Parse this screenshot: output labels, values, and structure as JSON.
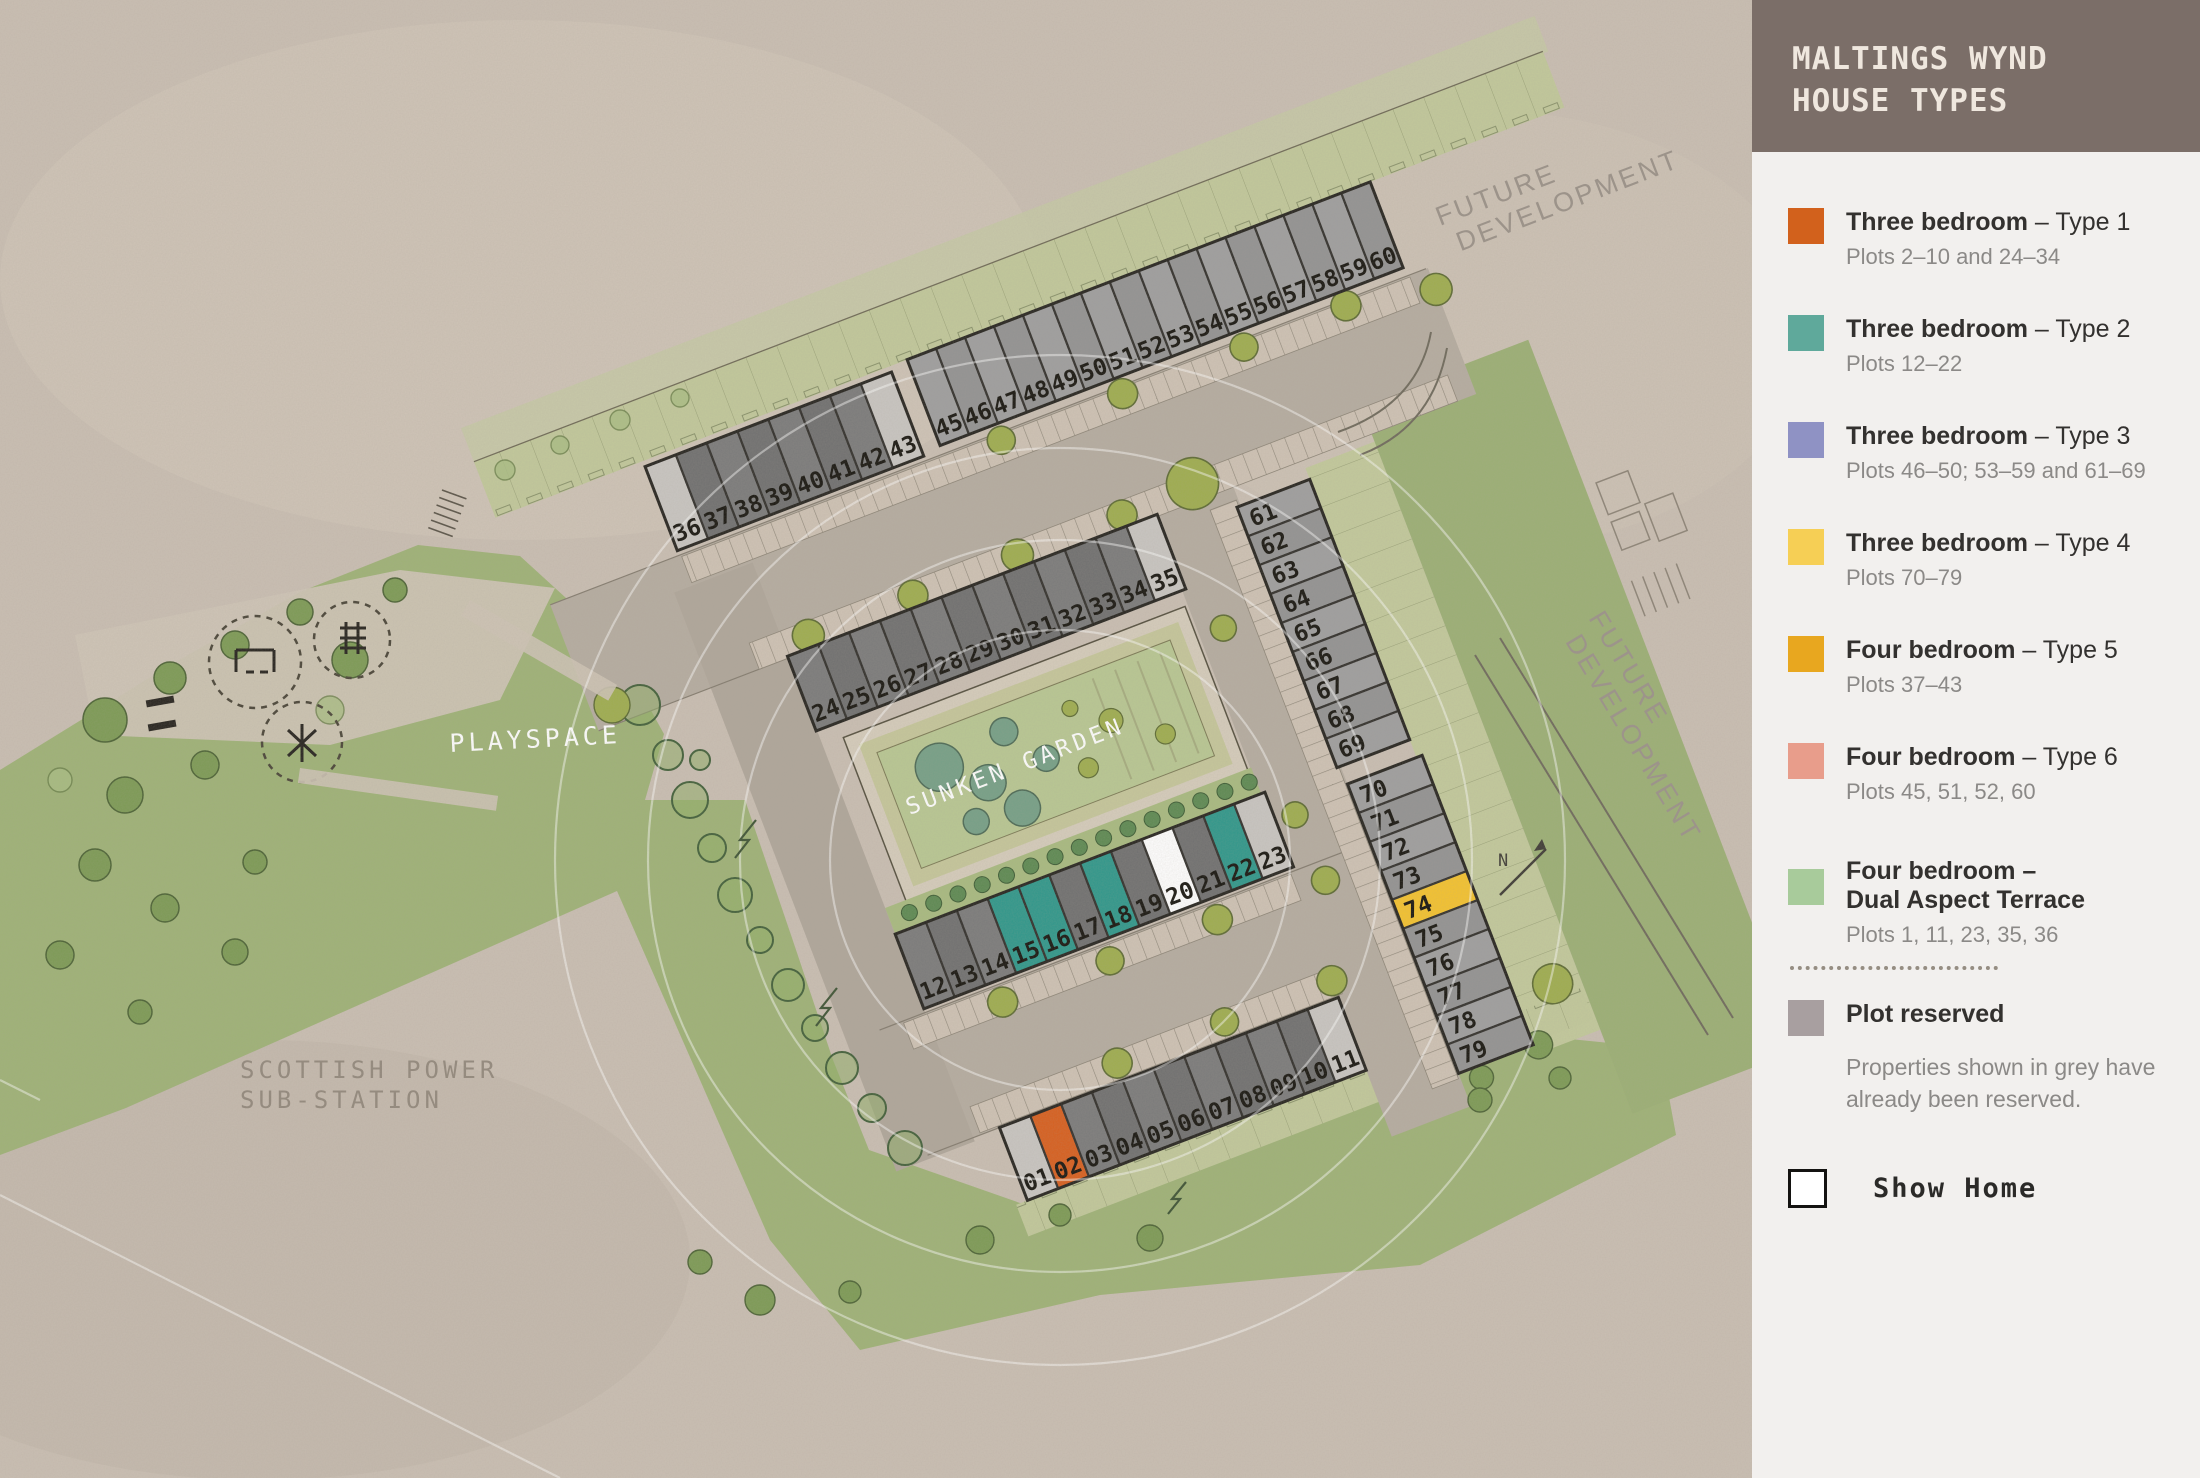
{
  "legend": {
    "title_line1": "MALTINGS WYND",
    "title_line2": "HOUSE TYPES",
    "items": [
      {
        "bold": "Three bedroom",
        "rest": " – Type 1",
        "sub": "Plots 2–10 and 24–34",
        "color": "#d2611c"
      },
      {
        "bold": "Three bedroom",
        "rest": " – Type 2",
        "sub": "Plots 12–22",
        "color": "#5fa99b"
      },
      {
        "bold": "Three bedroom",
        "rest": " – Type 3",
        "sub": "Plots 46–50; 53–59 and 61–69",
        "color": "#8f92c4"
      },
      {
        "bold": "Three bedroom",
        "rest": " – Type 4",
        "sub": "Plots 70–79",
        "color": "#f6cf55"
      },
      {
        "bold": "Four bedroom",
        "rest": " – Type 5",
        "sub": "Plots 37–43",
        "color": "#e8a71f"
      },
      {
        "bold": "Four bedroom",
        "rest": " – Type 6",
        "sub": "Plots 45, 51, 52, 60",
        "color": "#e89d8b"
      },
      {
        "bold": "Four bedroom –",
        "bold2": "Dual Aspect Terrace",
        "rest": "",
        "sub": "Plots 1, 11, 23, 35, 36",
        "color": "#a8cb9b"
      }
    ],
    "reserved": {
      "label": "Plot reserved",
      "sub1": "Properties shown in grey have",
      "sub2": "already been reserved.",
      "color": "#a89fa0"
    },
    "show_home": {
      "label": "Show Home",
      "color": "#ffffff"
    }
  },
  "map": {
    "labels": {
      "playspace": "PLAYSPACE",
      "sunken_garden": "SUNKEN GARDEN",
      "substation_line1": "SCOTTISH POWER",
      "substation_line2": "SUB-STATION",
      "future_dev_line1": "FUTURE",
      "future_dev_line2": "DEVELOPMENT",
      "north": "N"
    },
    "colors": {
      "r1": "#7b7b7b",
      "r2": "#707070",
      "m1": "#9f9f9f",
      "m2": "#939393",
      "rl": "#c9c6c2",
      "t1": "#d85f1e",
      "t2": "#2f988b",
      "t4": "#f5c32e",
      "sh": "#ffffff",
      "stroke": "#32302c"
    },
    "rows": [
      {
        "id": "A",
        "plots": [
          {
            "n": "36",
            "k": "rl"
          },
          {
            "n": "37",
            "k": "r"
          },
          {
            "n": "38",
            "k": "r"
          },
          {
            "n": "39",
            "k": "r"
          },
          {
            "n": "40",
            "k": "r"
          },
          {
            "n": "41",
            "k": "r"
          },
          {
            "n": "42",
            "k": "r"
          },
          {
            "n": "43",
            "k": "rl"
          }
        ]
      },
      {
        "id": "B",
        "plots": [
          {
            "n": "45",
            "k": "m"
          },
          {
            "n": "46",
            "k": "m"
          },
          {
            "n": "47",
            "k": "m"
          },
          {
            "n": "48",
            "k": "m"
          },
          {
            "n": "49",
            "k": "m"
          },
          {
            "n": "50",
            "k": "m"
          },
          {
            "n": "51",
            "k": "m"
          },
          {
            "n": "52",
            "k": "m"
          },
          {
            "n": "53",
            "k": "m"
          },
          {
            "n": "54",
            "k": "m"
          },
          {
            "n": "55",
            "k": "m"
          },
          {
            "n": "56",
            "k": "m"
          },
          {
            "n": "57",
            "k": "m"
          },
          {
            "n": "58",
            "k": "m"
          },
          {
            "n": "59",
            "k": "m"
          },
          {
            "n": "60",
            "k": "m"
          }
        ]
      },
      {
        "id": "C",
        "plots": [
          {
            "n": "61",
            "k": "m"
          },
          {
            "n": "62",
            "k": "m"
          },
          {
            "n": "63",
            "k": "m"
          },
          {
            "n": "64",
            "k": "m"
          },
          {
            "n": "65",
            "k": "m"
          },
          {
            "n": "66",
            "k": "m"
          },
          {
            "n": "67",
            "k": "m"
          },
          {
            "n": "68",
            "k": "m"
          },
          {
            "n": "69",
            "k": "m"
          }
        ]
      },
      {
        "id": "D",
        "plots": [
          {
            "n": "70",
            "k": "m"
          },
          {
            "n": "71",
            "k": "m"
          },
          {
            "n": "72",
            "k": "m"
          },
          {
            "n": "73",
            "k": "m"
          },
          {
            "n": "74",
            "k": "t4"
          },
          {
            "n": "75",
            "k": "m"
          },
          {
            "n": "76",
            "k": "m"
          },
          {
            "n": "77",
            "k": "m"
          },
          {
            "n": "78",
            "k": "m"
          },
          {
            "n": "79",
            "k": "m"
          }
        ]
      },
      {
        "id": "E",
        "plots": [
          {
            "n": "24",
            "k": "r"
          },
          {
            "n": "25",
            "k": "r"
          },
          {
            "n": "26",
            "k": "r"
          },
          {
            "n": "27",
            "k": "r"
          },
          {
            "n": "28",
            "k": "r"
          },
          {
            "n": "29",
            "k": "r"
          },
          {
            "n": "30",
            "k": "r"
          },
          {
            "n": "31",
            "k": "r"
          },
          {
            "n": "32",
            "k": "r"
          },
          {
            "n": "33",
            "k": "r"
          },
          {
            "n": "34",
            "k": "r"
          },
          {
            "n": "35",
            "k": "rl"
          }
        ]
      },
      {
        "id": "F",
        "plots": [
          {
            "n": "12",
            "k": "r"
          },
          {
            "n": "13",
            "k": "r"
          },
          {
            "n": "14",
            "k": "r"
          },
          {
            "n": "15",
            "k": "t2"
          },
          {
            "n": "16",
            "k": "t2"
          },
          {
            "n": "17",
            "k": "r"
          },
          {
            "n": "18",
            "k": "t2"
          },
          {
            "n": "19",
            "k": "r"
          },
          {
            "n": "20",
            "k": "sh"
          },
          {
            "n": "21",
            "k": "r"
          },
          {
            "n": "22",
            "k": "t2"
          },
          {
            "n": "23",
            "k": "rl"
          }
        ]
      },
      {
        "id": "G",
        "plots": [
          {
            "n": "01",
            "k": "rl"
          },
          {
            "n": "02",
            "k": "t1"
          },
          {
            "n": "03",
            "k": "r"
          },
          {
            "n": "04",
            "k": "r"
          },
          {
            "n": "05",
            "k": "r"
          },
          {
            "n": "06",
            "k": "r"
          },
          {
            "n": "07",
            "k": "r"
          },
          {
            "n": "08",
            "k": "r"
          },
          {
            "n": "09",
            "k": "r"
          },
          {
            "n": "10",
            "k": "r"
          },
          {
            "n": "11",
            "k": "rl"
          }
        ]
      }
    ]
  }
}
